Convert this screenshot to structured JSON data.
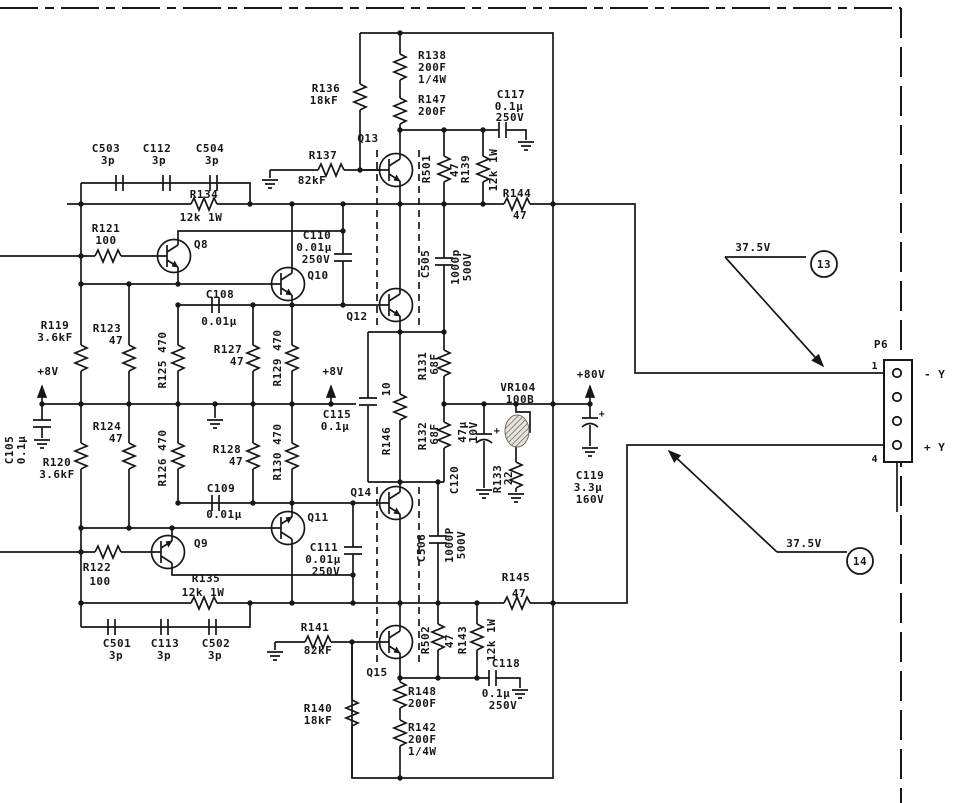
{
  "colors": {
    "ink": "#171717",
    "paper": "#ffffff"
  },
  "c": {
    "c503": {
      "ref": "C503",
      "v1": "3p"
    },
    "c112": {
      "ref": "C112",
      "v1": "3p"
    },
    "c504": {
      "ref": "C504",
      "v1": "3p"
    },
    "c501": {
      "ref": "C501",
      "v1": "3p"
    },
    "c113": {
      "ref": "C113",
      "v1": "3p"
    },
    "c502": {
      "ref": "C502",
      "v1": "3p"
    },
    "r134": {
      "ref": "R134",
      "v1": "12k 1W"
    },
    "r135": {
      "ref": "R135",
      "v1": "12k 1W"
    },
    "r121": {
      "ref": "R121",
      "v1": "100"
    },
    "r122": {
      "ref": "R122",
      "v1": "100"
    },
    "r119": {
      "ref": "R119",
      "v1": "3.6kF"
    },
    "r120": {
      "ref": "R120",
      "v1": "3.6kF"
    },
    "r123": {
      "ref": "R123",
      "v1": "47"
    },
    "r124": {
      "ref": "R124",
      "v1": "47"
    },
    "r127": {
      "ref": "R127",
      "v1": "47"
    },
    "r128": {
      "ref": "R128",
      "v1": "47"
    },
    "r125": {
      "ref": "R125 470"
    },
    "r126": {
      "ref": "R126 470"
    },
    "r129": {
      "ref": "R129 470"
    },
    "r130": {
      "ref": "R130 470"
    },
    "c105": {
      "ref": "C105",
      "v1": "0.1μ"
    },
    "c115": {
      "ref": "C115",
      "v1": "0.1μ"
    },
    "c108": {
      "ref": "C108",
      "v1": "0.01μ"
    },
    "c109": {
      "ref": "C109",
      "v1": "0.01μ"
    },
    "c110": {
      "ref": "C110",
      "v1": "0.01μ",
      "v2": "250V"
    },
    "c111": {
      "ref": "C111",
      "v1": "0.01μ",
      "v2": "250V"
    },
    "r136": {
      "ref": "R136",
      "v1": "18kF"
    },
    "r140": {
      "ref": "R140",
      "v1": "18kF"
    },
    "r137": {
      "ref": "R137",
      "v1": "82kF"
    },
    "r141": {
      "ref": "R141",
      "v1": "82kF"
    },
    "r138": {
      "ref": "R138",
      "v1": "200F",
      "v2": "1/4W"
    },
    "r142": {
      "ref": "R142",
      "v1": "200F",
      "v2": "1/4W"
    },
    "r147": {
      "ref": "R147",
      "v1": "200F"
    },
    "r148": {
      "ref": "R148",
      "v1": "200F"
    },
    "r501": {
      "ref": "R501",
      "v1": "47"
    },
    "r502": {
      "ref": "R502",
      "v1": "47"
    },
    "r139": {
      "ref": "R139",
      "v1": "12k 1W"
    },
    "r143": {
      "ref": "R143",
      "v1": "12k 1W"
    },
    "c505": {
      "ref": "C505",
      "v1": "1000p",
      "v2": "500V"
    },
    "c506": {
      "ref": "C506",
      "v1": "1000P",
      "v2": "500V"
    },
    "c117": {
      "ref": "C117",
      "v1": "0.1μ",
      "v2": "250V"
    },
    "c118": {
      "ref": "C118",
      "v1": "0.1μ",
      "v2": "250V"
    },
    "r144": {
      "ref": "R144",
      "v1": "47"
    },
    "r145": {
      "ref": "R145",
      "v1": "47"
    },
    "r146": {
      "ref": "R146",
      "v1": "10"
    },
    "r131": {
      "ref": "R131",
      "v1": "68F"
    },
    "r132": {
      "ref": "R132",
      "v1": "68F"
    },
    "r133": {
      "ref": "R133",
      "v1": "22"
    },
    "c119": {
      "ref": "C119",
      "v1": "3.3μ",
      "v2": "160V"
    },
    "c120": {
      "ref": "C120",
      "v1": "47μ",
      "v2": "10V"
    },
    "vr104": {
      "ref": "VR104",
      "v1": "100B"
    }
  },
  "q": {
    "q8": "Q8",
    "q9": "Q9",
    "q10": "Q10",
    "q11": "Q11",
    "q12": "Q12",
    "q13": "Q13",
    "q14": "Q14",
    "q15": "Q15"
  },
  "pwr": {
    "p8v": "+8V",
    "p80v": "+80V",
    "plus": "+"
  },
  "callout": {
    "v13": {
      "label": "37.5V",
      "num": "13"
    },
    "v14": {
      "label": "37.5V",
      "num": "14"
    }
  },
  "conn": {
    "name": "P6",
    "pin_top": "1",
    "pin_bot": "4",
    "neg": "- Y",
    "pos": "+ Y"
  }
}
